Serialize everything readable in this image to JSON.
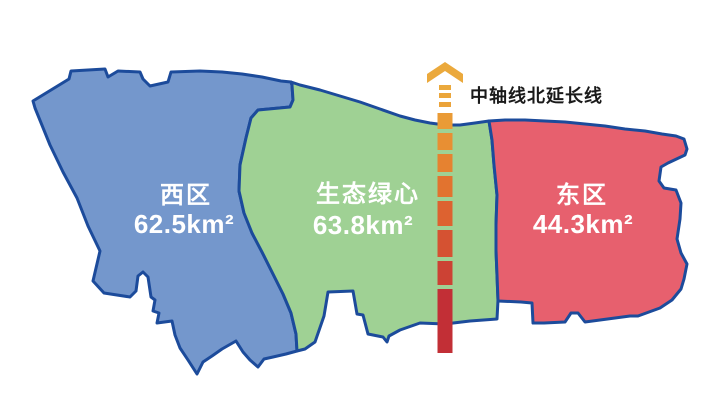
{
  "title": "城市三区分区示意图",
  "colors": {
    "background": "#FFFFFF",
    "border": "#1C4B9B",
    "west_fill": "#7497CC",
    "green_fill": "#9FD194",
    "east_fill": "#E7606E",
    "axis_arrow": "#EBA93C",
    "axis_label_color": "#1A1A1A",
    "region_label_color": "#FFFFFF"
  },
  "regions": [
    {
      "id": "west",
      "name": "西区",
      "area": "62.5km²"
    },
    {
      "id": "green-heart",
      "name": "生态绿心",
      "area": "63.8km²"
    },
    {
      "id": "east",
      "name": "东区",
      "area": "44.3km²"
    }
  ],
  "axis": {
    "label": "中轴线北延长线",
    "icon": "up-arrow-chevron-icon",
    "segments": [
      {
        "y": 85,
        "h": 5,
        "w": 12,
        "color": "#EBA93C"
      },
      {
        "y": 93,
        "h": 5,
        "w": 12,
        "color": "#EBA63B"
      },
      {
        "y": 102,
        "h": 5,
        "w": 12,
        "color": "#EBA33A"
      },
      {
        "y": 113,
        "h": 16,
        "w": 15,
        "color": "#EA9B36"
      },
      {
        "y": 133,
        "h": 17,
        "w": 15,
        "color": "#E88F33"
      },
      {
        "y": 154,
        "h": 18,
        "w": 15,
        "color": "#E68230"
      },
      {
        "y": 176,
        "h": 21,
        "w": 15,
        "color": "#E2732F"
      },
      {
        "y": 201,
        "h": 25,
        "w": 15,
        "color": "#DD6230"
      },
      {
        "y": 230,
        "h": 27,
        "w": 15,
        "color": "#D55232"
      },
      {
        "y": 261,
        "h": 24,
        "w": 15,
        "color": "#CC4234"
      },
      {
        "y": 289,
        "h": 64,
        "w": 15,
        "color": "#C22F36"
      }
    ]
  }
}
